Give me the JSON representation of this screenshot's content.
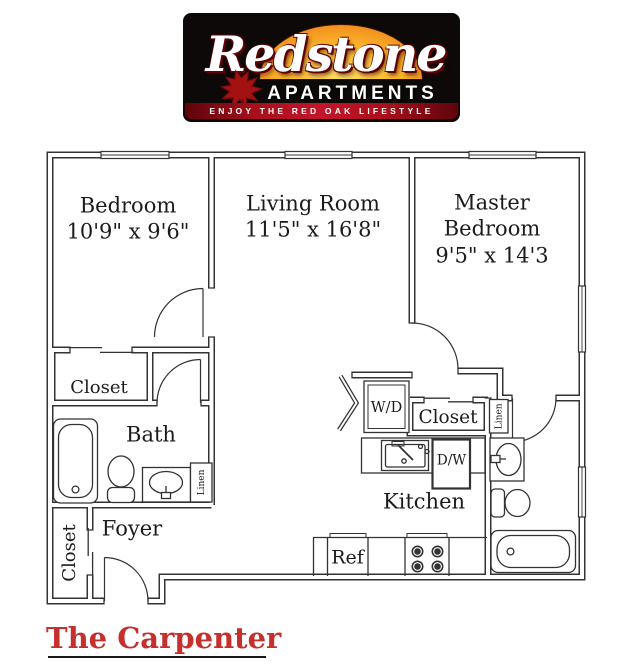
{
  "logo": {
    "brand": "Redstone",
    "wordmark_sub": "APARTMENTS",
    "tagline": "ENJOY THE RED OAK LIFESTYLE"
  },
  "floorplan": {
    "rooms": {
      "bedroom": {
        "name": "Bedroom",
        "dims": "10'9\" x 9'6\""
      },
      "living_room": {
        "name": "Living Room",
        "dims": "11'5\" x 16'8\""
      },
      "master_bedroom": {
        "name_line1": "Master",
        "name_line2": "Bedroom",
        "dims": "9'5\" x 14'3"
      },
      "bath": {
        "name": "Bath"
      },
      "foyer": {
        "name": "Foyer"
      },
      "kitchen": {
        "name": "Kitchen"
      }
    },
    "labels": {
      "bedroom_closet": "Closet",
      "foyer_closet": "Closet",
      "master_closet": "Closet",
      "bath_linen": "Linen",
      "hall_linen": "Linen",
      "washer_dryer": "W/D",
      "dishwasher": "D/W",
      "refrigerator": "Ref"
    }
  },
  "title": "The Carpenter",
  "colors": {
    "title_red": "#c5302d",
    "logo_background": "#0c0908",
    "banner_red": "#a60f1a",
    "sunset_orange": "#f08a1d",
    "leaf_red": "#a31111",
    "plan_line": "#333333"
  }
}
